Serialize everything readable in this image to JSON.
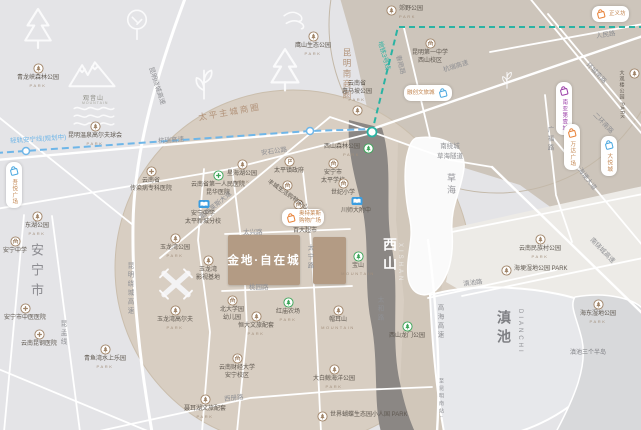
{
  "project": {
    "name": "金地·自在城"
  },
  "colors": {
    "park_brown": "#a08468",
    "park_green": "#3aa558",
    "school_blue": "#3b9de0",
    "metro_teal": "#2ab3a3",
    "rail_blue": "#6fb6e8",
    "shop_orange": "#e8833a",
    "shop_purple": "#9b3fa8",
    "shop_skyblue": "#4aa8e0",
    "block_brown": "#b39b84"
  },
  "areas": [
    {
      "t": "安宁市",
      "x": 27,
      "y": 243,
      "cls": "city"
    },
    {
      "t": "西山",
      "x": 380,
      "y": 237,
      "cls": "xishan"
    },
    {
      "t": "XISHAN",
      "x": 397,
      "y": 243,
      "cls": "xishan-en"
    },
    {
      "t": "滇池",
      "x": 494,
      "y": 310,
      "cls": "lake"
    },
    {
      "t": "DIANCHI",
      "x": 517,
      "y": 309,
      "cls": "lake-en"
    },
    {
      "t": "草海",
      "x": 445,
      "y": 173,
      "cls": "caohai"
    },
    {
      "t": "太平主城商圈",
      "x": 198,
      "y": 106,
      "cls": "biz",
      "r": -10
    },
    {
      "t": "昆明南商圈",
      "x": 341,
      "y": 48,
      "cls": "biz vert2"
    },
    {
      "t": "滇池三个半岛",
      "x": 570,
      "y": 347,
      "cls": "small-gray"
    },
    {
      "t": "观音山",
      "x": 83,
      "y": 93,
      "cls": "mtn-name"
    },
    {
      "t": "MOUNTAIN",
      "x": 82,
      "y": 101,
      "cls": "mtn-en"
    }
  ],
  "road_labels": [
    {
      "t": "人民路",
      "x": 596,
      "y": 30,
      "r": -8
    },
    {
      "t": "环城南路",
      "x": 588,
      "y": 58,
      "r": 46
    },
    {
      "t": "二环南路",
      "x": 595,
      "y": 108,
      "r": 46
    },
    {
      "t": "广福路",
      "x": 544,
      "y": 126,
      "v": true
    },
    {
      "t": "海埂大道",
      "x": 580,
      "y": 163,
      "r": 52
    },
    {
      "t": "南绕城高速",
      "x": 592,
      "y": 233,
      "r": 46
    },
    {
      "t": "滇池路",
      "x": 463,
      "y": 278,
      "r": -7
    },
    {
      "t": "高海高速",
      "x": 434,
      "y": 304,
      "v": true
    },
    {
      "t": "太和路",
      "x": 374,
      "y": 296,
      "v": true
    },
    {
      "t": "太宁路",
      "x": 304,
      "y": 244,
      "v": true
    },
    {
      "t": "太兴路",
      "x": 243,
      "y": 226
    },
    {
      "t": "桃园路",
      "x": 249,
      "y": 281
    },
    {
      "t": "西册路",
      "x": 224,
      "y": 393,
      "r": -6
    },
    {
      "t": "奥特莱斯大道",
      "x": 200,
      "y": 212,
      "r": -40
    },
    {
      "t": "安石公路",
      "x": 261,
      "y": 147,
      "r": -8
    },
    {
      "t": "杭瑞高速",
      "x": 443,
      "y": 64,
      "r": -17
    },
    {
      "t": "杭瑞高速",
      "x": 158,
      "y": 135,
      "r": -4
    },
    {
      "t": "昆明绕城高速",
      "x": 152,
      "y": 62,
      "r": 72
    },
    {
      "t": "昆明绕城高速",
      "x": 124,
      "y": 262,
      "v": true
    },
    {
      "t": "昆孟线",
      "x": 57,
      "y": 320,
      "v": true
    },
    {
      "t": "春雨路",
      "x": 399,
      "y": 50,
      "r": 75
    },
    {
      "t": "南绕城<br>草海隧道",
      "x": 437,
      "y": 140,
      "html": true
    },
    {
      "t": "轻轨安宁线(规划中)",
      "x": 10,
      "y": 135,
      "r": -4,
      "c": "rail_blue"
    },
    {
      "t": "地铁3号线",
      "x": 381,
      "y": 36,
      "r": 74,
      "c": "metro_teal"
    },
    {
      "t": "至昆明南站↓",
      "x": 438,
      "y": 378,
      "v": true,
      "s": 5
    }
  ],
  "pois": [
    {
      "k": "park",
      "x": 38,
      "y": 68,
      "l": [
        "青龙峡森林公园",
        "PARK"
      ]
    },
    {
      "k": "park",
      "x": 95,
      "y": 126,
      "l": [
        "昆明温泉高尔夫球会",
        "PARK"
      ]
    },
    {
      "k": "park",
      "x": 313,
      "y": 36,
      "l": [
        "鹰山生态公园",
        "PARK"
      ]
    },
    {
      "k": "park",
      "x": 391,
      "y": 10,
      "l": [
        "郊野公园",
        "PARK"
      ],
      "lp": "right"
    },
    {
      "k": "park",
      "x": 357,
      "y": 110,
      "l": [
        "云南省",
        "惠马坡公园",
        "PARK"
      ],
      "lp": "above"
    },
    {
      "k": "park",
      "x": 634,
      "y": 73,
      "l": [
        "大观楼公园 PARK"
      ],
      "lp": "leftv"
    },
    {
      "k": "park",
      "x": 242,
      "y": 164,
      "l": [
        "星海湖公园",
        "PARK"
      ]
    },
    {
      "k": "park",
      "x": 37,
      "y": 216,
      "l": [
        "东湖公园",
        "PARK"
      ]
    },
    {
      "k": "park",
      "x": 175,
      "y": 238,
      "l": [
        "玉龙湾公园",
        "PARK"
      ]
    },
    {
      "k": "park",
      "x": 208,
      "y": 260,
      "l": [
        "玉龙湾",
        "影视基地"
      ]
    },
    {
      "k": "park",
      "x": 175,
      "y": 310,
      "l": [
        "玉龙湾高尔夫",
        "PARK"
      ]
    },
    {
      "k": "park",
      "x": 105,
      "y": 349,
      "l": [
        "青鱼湾水上乐园",
        "PARK"
      ]
    },
    {
      "k": "park-green",
      "x": 288,
      "y": 302,
      "l": [
        "红庙农场",
        "PARK"
      ]
    },
    {
      "k": "park-green",
      "x": 368,
      "y": 148,
      "l": [
        "西山森林公园",
        "PARK"
      ],
      "lp": "left"
    },
    {
      "k": "park-green",
      "x": 358,
      "y": 256,
      "l": [
        "宝山",
        "MOUNTAIN"
      ]
    },
    {
      "k": "park-green",
      "x": 407,
      "y": 326,
      "l": [
        "西山龙门公园"
      ]
    },
    {
      "k": "park",
      "x": 338,
      "y": 310,
      "l": [
        "帽耳山",
        "MOUNTAIN"
      ]
    },
    {
      "k": "park",
      "x": 598,
      "y": 304,
      "l": [
        "海东湿地公园",
        "PARK"
      ]
    },
    {
      "k": "park",
      "x": 540,
      "y": 239,
      "l": [
        "云南民族村公园",
        "PARK"
      ]
    },
    {
      "k": "park",
      "x": 506,
      "y": 270,
      "l": [
        "海埂湿地公园 PARK"
      ],
      "lp": "right"
    },
    {
      "k": "park",
      "x": 334,
      "y": 369,
      "l": [
        "大白鲸海洋公园",
        "PARK"
      ]
    },
    {
      "k": "park",
      "x": 322,
      "y": 416,
      "l": [
        "世界蝴蝶生态园小人国 PARK"
      ],
      "lp": "right"
    },
    {
      "k": "park",
      "x": 205,
      "y": 399,
      "l": [
        "聂耳湖文旅配套",
        "PARK"
      ]
    },
    {
      "k": "park",
      "x": 256,
      "y": 316,
      "l": [
        "恒大文旅配套",
        "PARK"
      ]
    },
    {
      "k": "civic",
      "x": 232,
      "y": 300,
      "l": [
        "北大学园",
        "幼儿园"
      ]
    },
    {
      "k": "civic",
      "x": 237,
      "y": 358,
      "l": [
        "云南财经大学",
        "安宁校区"
      ]
    },
    {
      "k": "civic",
      "x": 430,
      "y": 43,
      "l": [
        "昆明第一中学",
        "西山校区"
      ]
    },
    {
      "k": "civic",
      "x": 333,
      "y": 163,
      "l": [
        "安宁市",
        "太平学校"
      ]
    },
    {
      "k": "civic",
      "x": 343,
      "y": 183,
      "l": [
        "世纪小学"
      ]
    },
    {
      "k": "school",
      "x": 356,
      "y": 201,
      "l": [
        "川师大附中"
      ]
    },
    {
      "k": "school",
      "x": 203,
      "y": 204,
      "l": [
        "安宁中学",
        "太平新城分校"
      ]
    },
    {
      "k": "hospital",
      "x": 151,
      "y": 171,
      "l": [
        "云南省",
        "传染病专科医院"
      ]
    },
    {
      "k": "hospital-g",
      "x": 218,
      "y": 175,
      "l": [
        "云南省第一人民医院",
        "昆华医院"
      ]
    },
    {
      "k": "hospital",
      "x": 25,
      "y": 308,
      "l": [
        "安宁市中医医院"
      ]
    },
    {
      "k": "hospital",
      "x": 39,
      "y": 334,
      "l": [
        "云南昆钢医院"
      ]
    },
    {
      "k": "civic",
      "x": 15,
      "y": 241,
      "l": [
        "安宁中学"
      ]
    },
    {
      "k": "gov",
      "x": 289,
      "y": 161,
      "l": [
        "太平镇政府"
      ]
    },
    {
      "k": "civic",
      "x": 298,
      "y": 204,
      "l": [
        "农贸市场"
      ]
    },
    {
      "k": "civic",
      "x": 305,
      "y": 221,
      "l": [
        "百大超市"
      ]
    },
    {
      "k": "civic",
      "x": 287,
      "y": 185,
      "l": [
        "丰城生活购物中心"
      ],
      "r": 35
    }
  ],
  "pills": [
    {
      "t": "正义坊",
      "x": 592,
      "y": 6,
      "dir": "h",
      "icon": "shop_orange"
    },
    {
      "t": "融创文旅城",
      "x": 404,
      "y": 85,
      "dir": "h",
      "icon": "shop_skyblue",
      "iconSide": "right"
    },
    {
      "t": "奥特莱斯<br>购物广场",
      "x": 282,
      "y": 209,
      "dir": "h",
      "icon": "shop_orange",
      "html": true
    },
    {
      "t": "吾悦广场",
      "x": 6,
      "y": 162,
      "dir": "v",
      "icon": "shop_skyblue"
    },
    {
      "t": "南亚第壹城",
      "x": 556,
      "y": 82,
      "dir": "v",
      "icon": "shop_purple",
      "tc": "#9b3fa8"
    },
    {
      "t": "万达广场",
      "x": 564,
      "y": 124,
      "dir": "v",
      "icon": "shop_orange"
    },
    {
      "t": "大悦城",
      "x": 601,
      "y": 136,
      "dir": "v",
      "icon": "shop_skyblue"
    }
  ],
  "decor": [
    {
      "k": "pine",
      "x": 20,
      "y": 6,
      "s": 36
    },
    {
      "k": "tree",
      "x": 123,
      "y": 8,
      "s": 28
    },
    {
      "k": "mtn",
      "x": 68,
      "y": 58,
      "s": 48
    },
    {
      "k": "waves",
      "x": 72,
      "y": 103,
      "s": 44
    },
    {
      "k": "wind",
      "x": 282,
      "y": 6,
      "s": 26
    },
    {
      "k": "leaf",
      "x": 188,
      "y": 68,
      "s": 32
    },
    {
      "k": "pine",
      "x": 266,
      "y": 46,
      "s": 38
    },
    {
      "k": "windmill",
      "x": 156,
      "y": 264,
      "s": 40
    },
    {
      "k": "leaf",
      "x": 498,
      "y": 71,
      "s": 18
    }
  ]
}
